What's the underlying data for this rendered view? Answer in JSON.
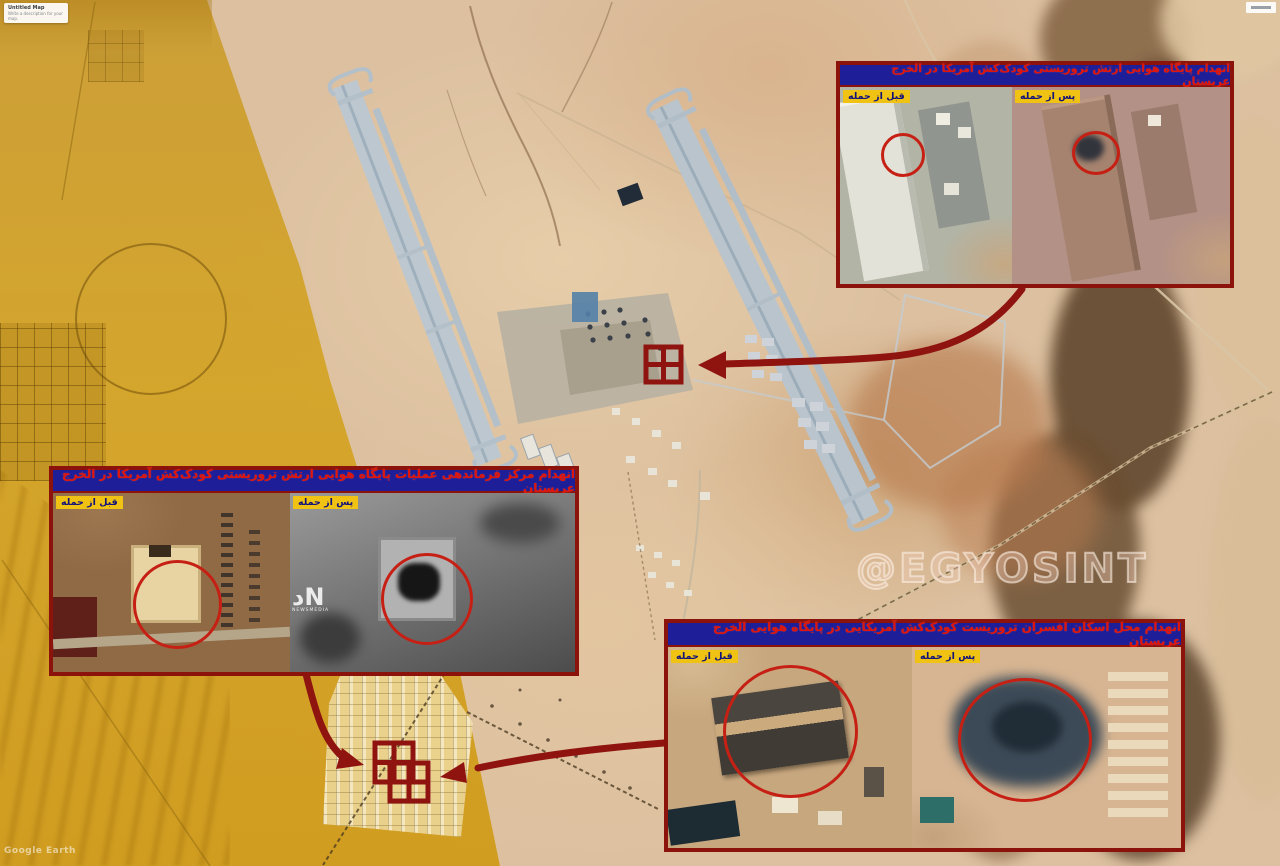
{
  "map": {
    "card": {
      "title": "Untitled Map",
      "subtitle": "Write a description for your map."
    },
    "google_earth_watermark": "Google Earth",
    "osint_watermark": "@EGYOSINT"
  },
  "labels": {
    "before": "قبل از حمله",
    "after": "پس از حمله"
  },
  "panels": [
    {
      "id": "airbase",
      "title": "انهدام پایگاه هوایی ارتش تروریستی کودک‌کش آمریکا در الخرج عربستان"
    },
    {
      "id": "command-center",
      "title": "انهدام مرکز فرماندهی عملیات پایگاه هوایی ارتش تروریستی کودک‌کش آمریکا در الخرج عربستان",
      "logo": {
        "monogram": "دN",
        "caption": "NEWSMEDIA"
      }
    },
    {
      "id": "officers-housing",
      "title": "انهدام محل اسکان افسران تروریست کودک‌کش آمریکایی در پایگاه هوایی الخرج عربستان"
    }
  ],
  "colors": {
    "annotation_red": "#8f1410",
    "inset_border_red": "#8c130c",
    "title_bar_blue": "#1e1e99",
    "title_text_red": "#e01408",
    "label_yellow": "#f0c213",
    "label_text_blue": "#12127a",
    "gold_overlay": "#cf9c10",
    "desert_base": "#dcc0a0"
  }
}
